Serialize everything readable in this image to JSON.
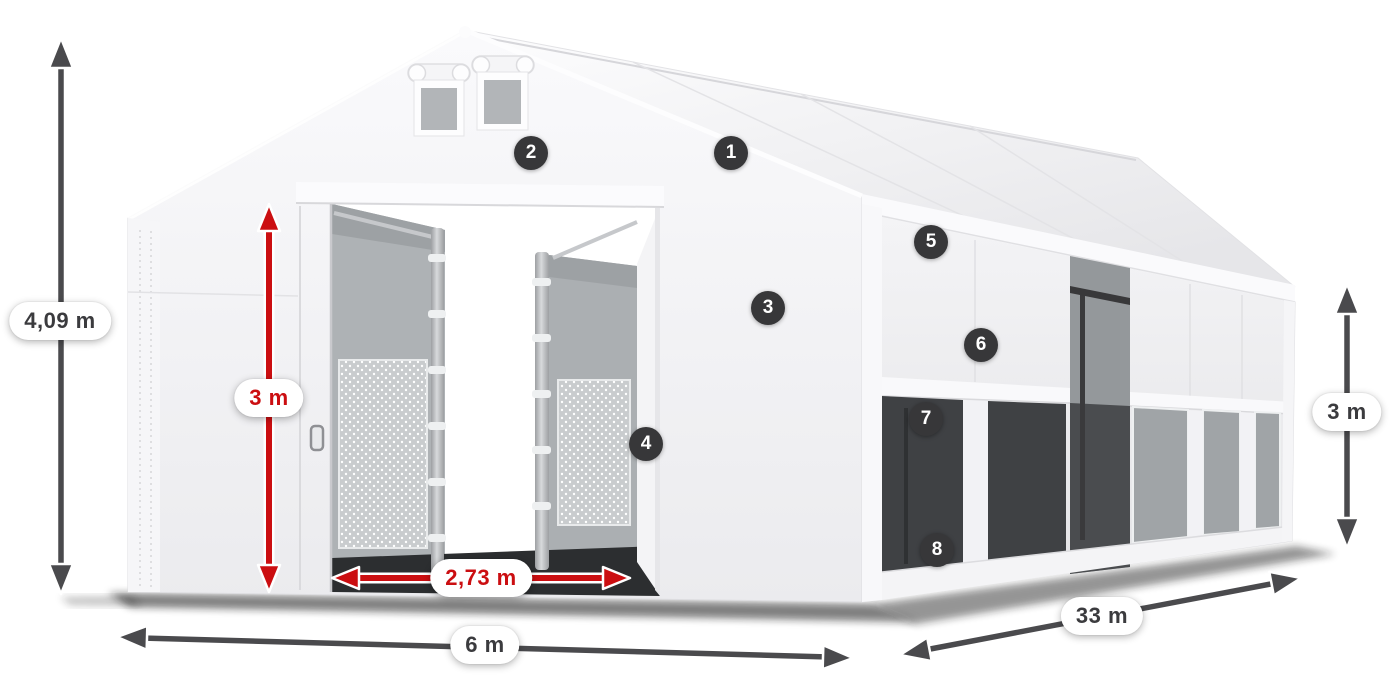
{
  "colors": {
    "accent_red": "#cb0e11",
    "arrow_gray": "#4a4a4d",
    "badge_bg": "#373739",
    "badge_text": "#ffffff",
    "label_text": "#3b3b3e",
    "pill_bg": "#ffffff"
  },
  "dimensions": {
    "total_height": {
      "label": "4,09 m"
    },
    "door_height": {
      "label": "3 m"
    },
    "door_width": {
      "label": "2,73 m"
    },
    "front_width": {
      "label": "6 m"
    },
    "side_length": {
      "label": "33 m"
    },
    "side_height": {
      "label": "3 m"
    }
  },
  "markers": [
    {
      "number": "1",
      "x": 731,
      "y": 153
    },
    {
      "number": "2",
      "x": 531,
      "y": 153
    },
    {
      "number": "3",
      "x": 768,
      "y": 308
    },
    {
      "number": "4",
      "x": 646,
      "y": 444
    },
    {
      "number": "5",
      "x": 931,
      "y": 242
    },
    {
      "number": "6",
      "x": 981,
      "y": 345
    },
    {
      "number": "7",
      "x": 926,
      "y": 419
    },
    {
      "number": "8",
      "x": 937,
      "y": 550
    }
  ]
}
